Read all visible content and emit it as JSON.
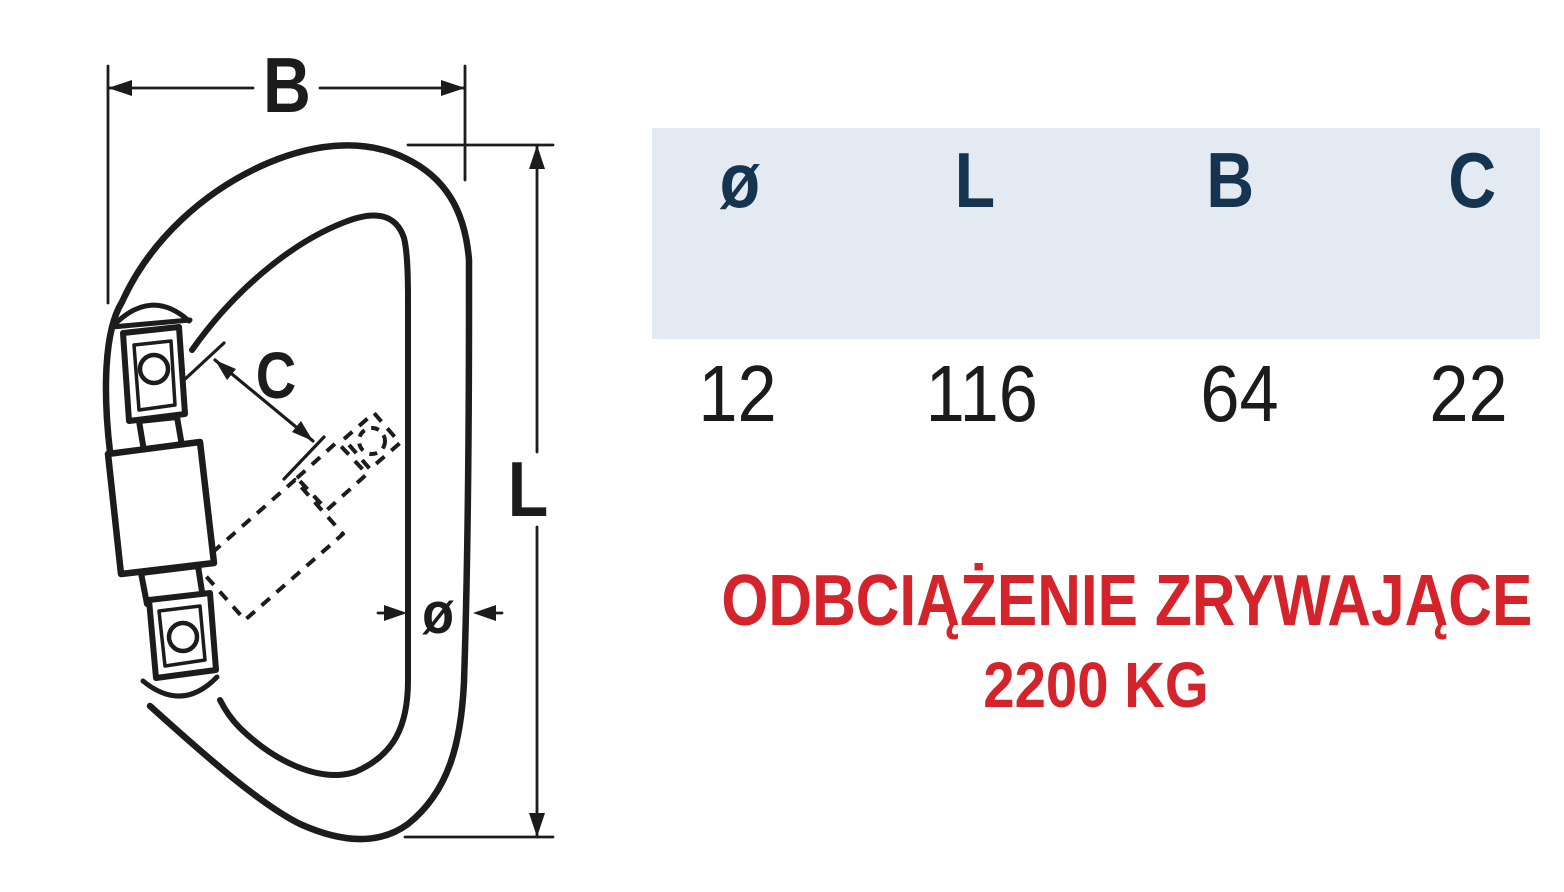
{
  "drawing": {
    "labels": {
      "width": "B",
      "length": "L",
      "opening": "C",
      "diameter": "ø"
    }
  },
  "table": {
    "columns": [
      {
        "label": "ø",
        "value": "12"
      },
      {
        "label": "L",
        "value": "116"
      },
      {
        "label": "B",
        "value": "64"
      },
      {
        "label": "C",
        "value": "22"
      }
    ]
  },
  "banner": {
    "line1": "ODBCIĄŻENIE ZRYWAJĄCE",
    "line2": "2200 KG"
  },
  "colors": {
    "header_background": "#e4eaf1",
    "header_text": "#14344f",
    "value_text": "#1b1b1b",
    "accent_red": "#d4232a",
    "line_art": "#1c1c1c"
  }
}
